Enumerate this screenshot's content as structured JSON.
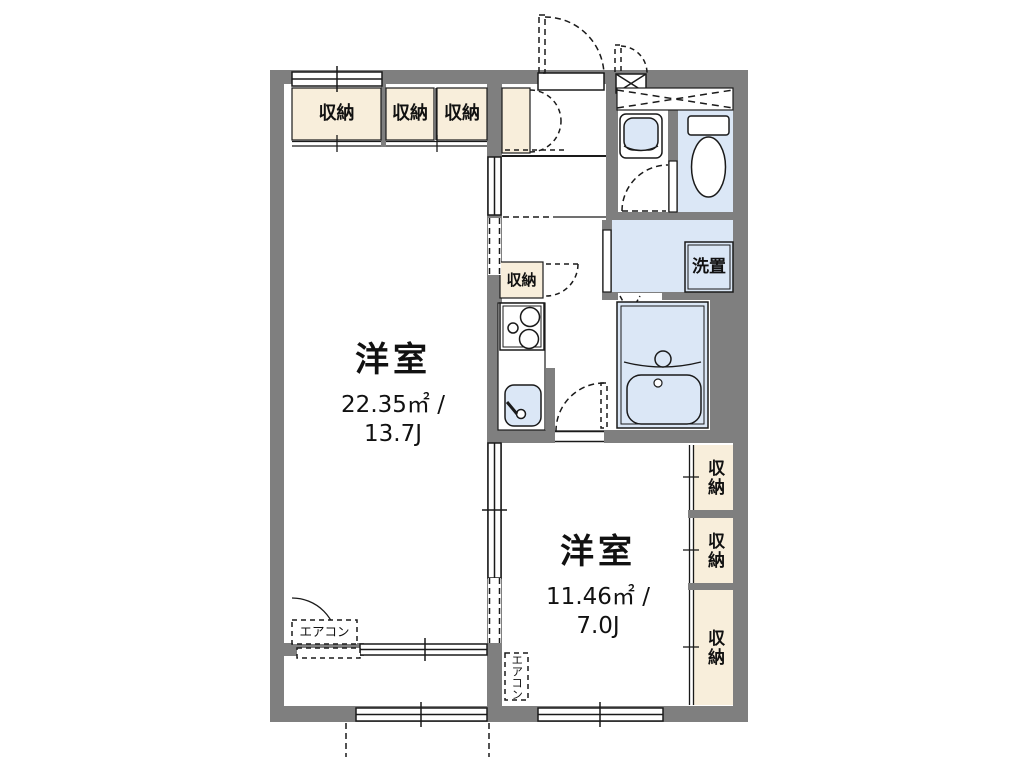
{
  "plan": {
    "type": "apartment-floor-plan",
    "rooms": [
      {
        "id": "western-room-1",
        "label": "洋室",
        "area": "22.35㎡ /",
        "size_jo": "13.7J"
      },
      {
        "id": "western-room-2",
        "label": "洋室",
        "area": "11.46㎡ /",
        "size_jo": "7.0J"
      }
    ],
    "storage_label": "収納",
    "washer_label": "洗置",
    "aircon_label": "エアコン",
    "colors": {
      "wall": "#7F7F7F",
      "storage_fill": "#F8EEDB",
      "water_fill": "#DBE7F6",
      "line": "#1A1A1A",
      "background": "#FFFFFF"
    }
  }
}
